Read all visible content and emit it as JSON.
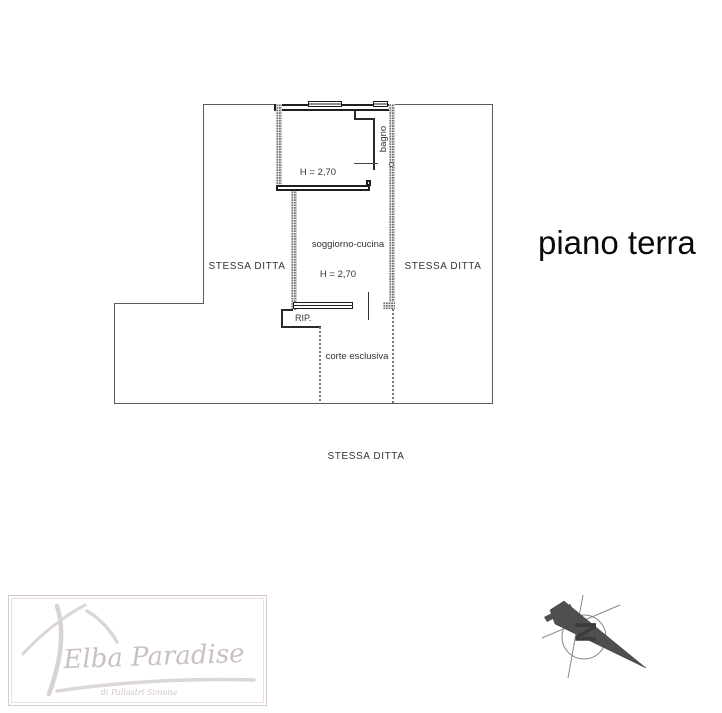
{
  "page_title": "piano terra",
  "floorplan": {
    "rooms": {
      "room_top_height": "H = 2,70",
      "bagno_label": "bagno",
      "soggiorno_label": "soggiorno-cucina",
      "soggiorno_height": "H = 2,70",
      "rip_label": "RIP.",
      "corte_label": "corte esclusiva"
    },
    "adjacent": {
      "left": "STESSA DITTA",
      "right": "STESSA DITTA",
      "bottom": "STESSA DITTA"
    }
  },
  "compass": {
    "north_label": "N"
  },
  "logo": {
    "brand": "Elba Paradise",
    "subtitle": "di Pallastri Simona"
  },
  "colors": {
    "wall": "#1f1f1f",
    "boundary": "#5a5a5a",
    "hatch_dot": "#6d6d6d",
    "title_text": "#0a0a0a",
    "label_text": "#333333",
    "logo_ink": "#c9c0c0",
    "compass_fill": "#4f4f4f"
  }
}
